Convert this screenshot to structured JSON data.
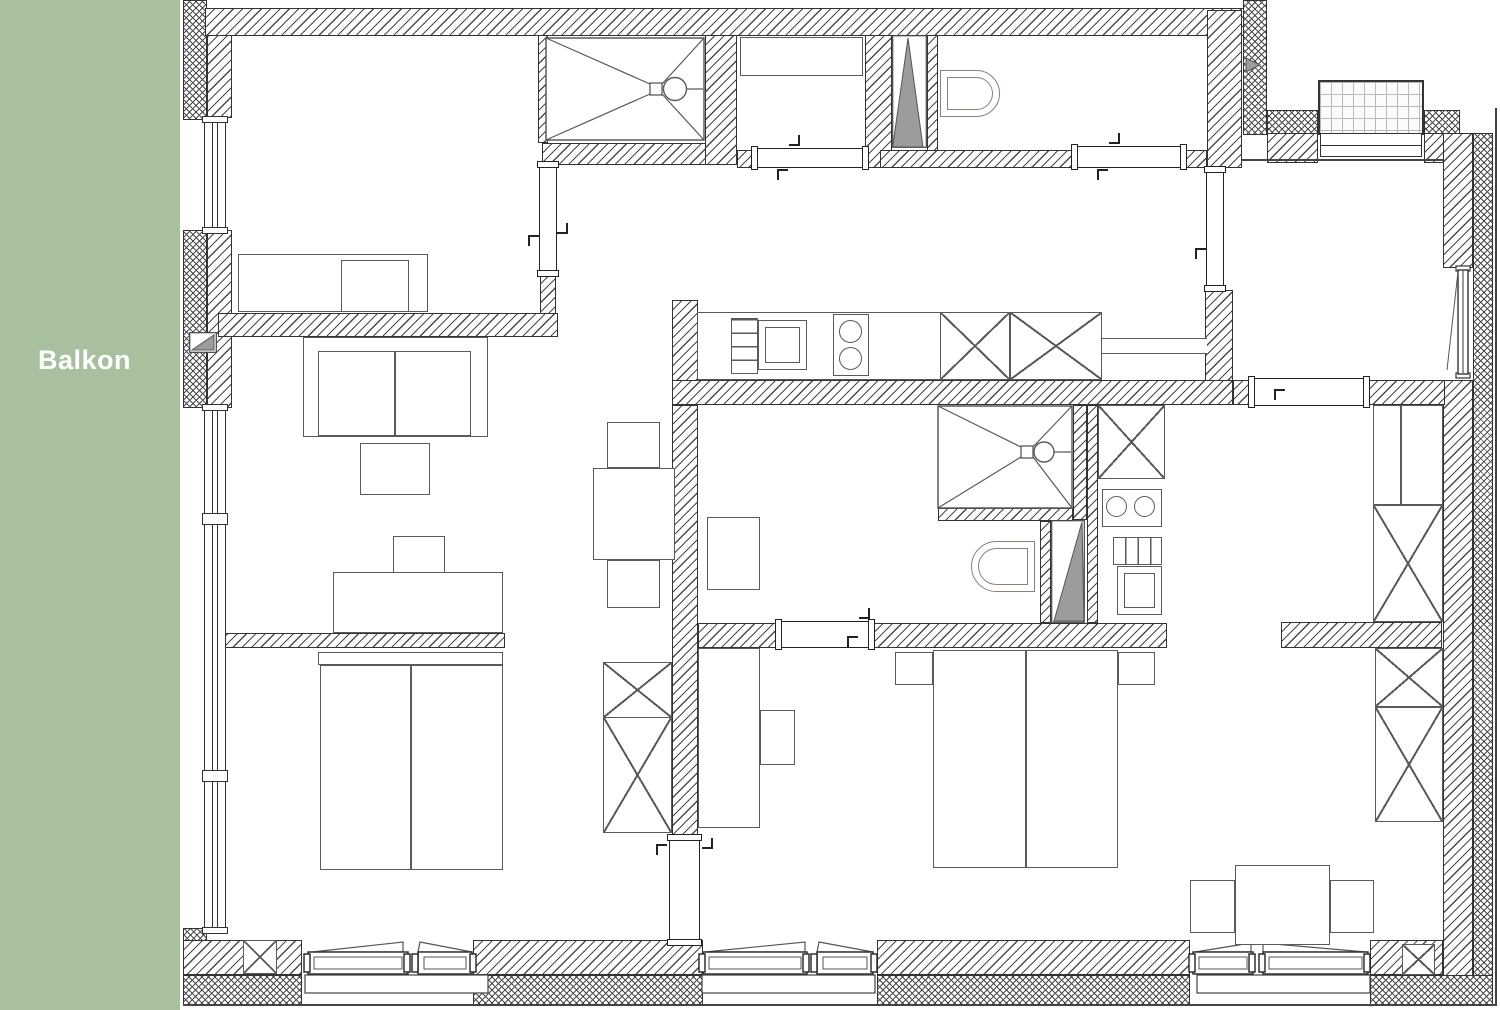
{
  "balcony": {
    "label": "Balkon"
  },
  "colors": {
    "balcony_green": "#a8c0a0",
    "wall_line": "#333333",
    "hatch_line": "#4a4a4a",
    "furniture_line": "#5a5a5a",
    "shaft_gray": "#9c9c9c",
    "toilet_line": "#8b8175",
    "glass_grid_line": "#b8b8b8"
  }
}
